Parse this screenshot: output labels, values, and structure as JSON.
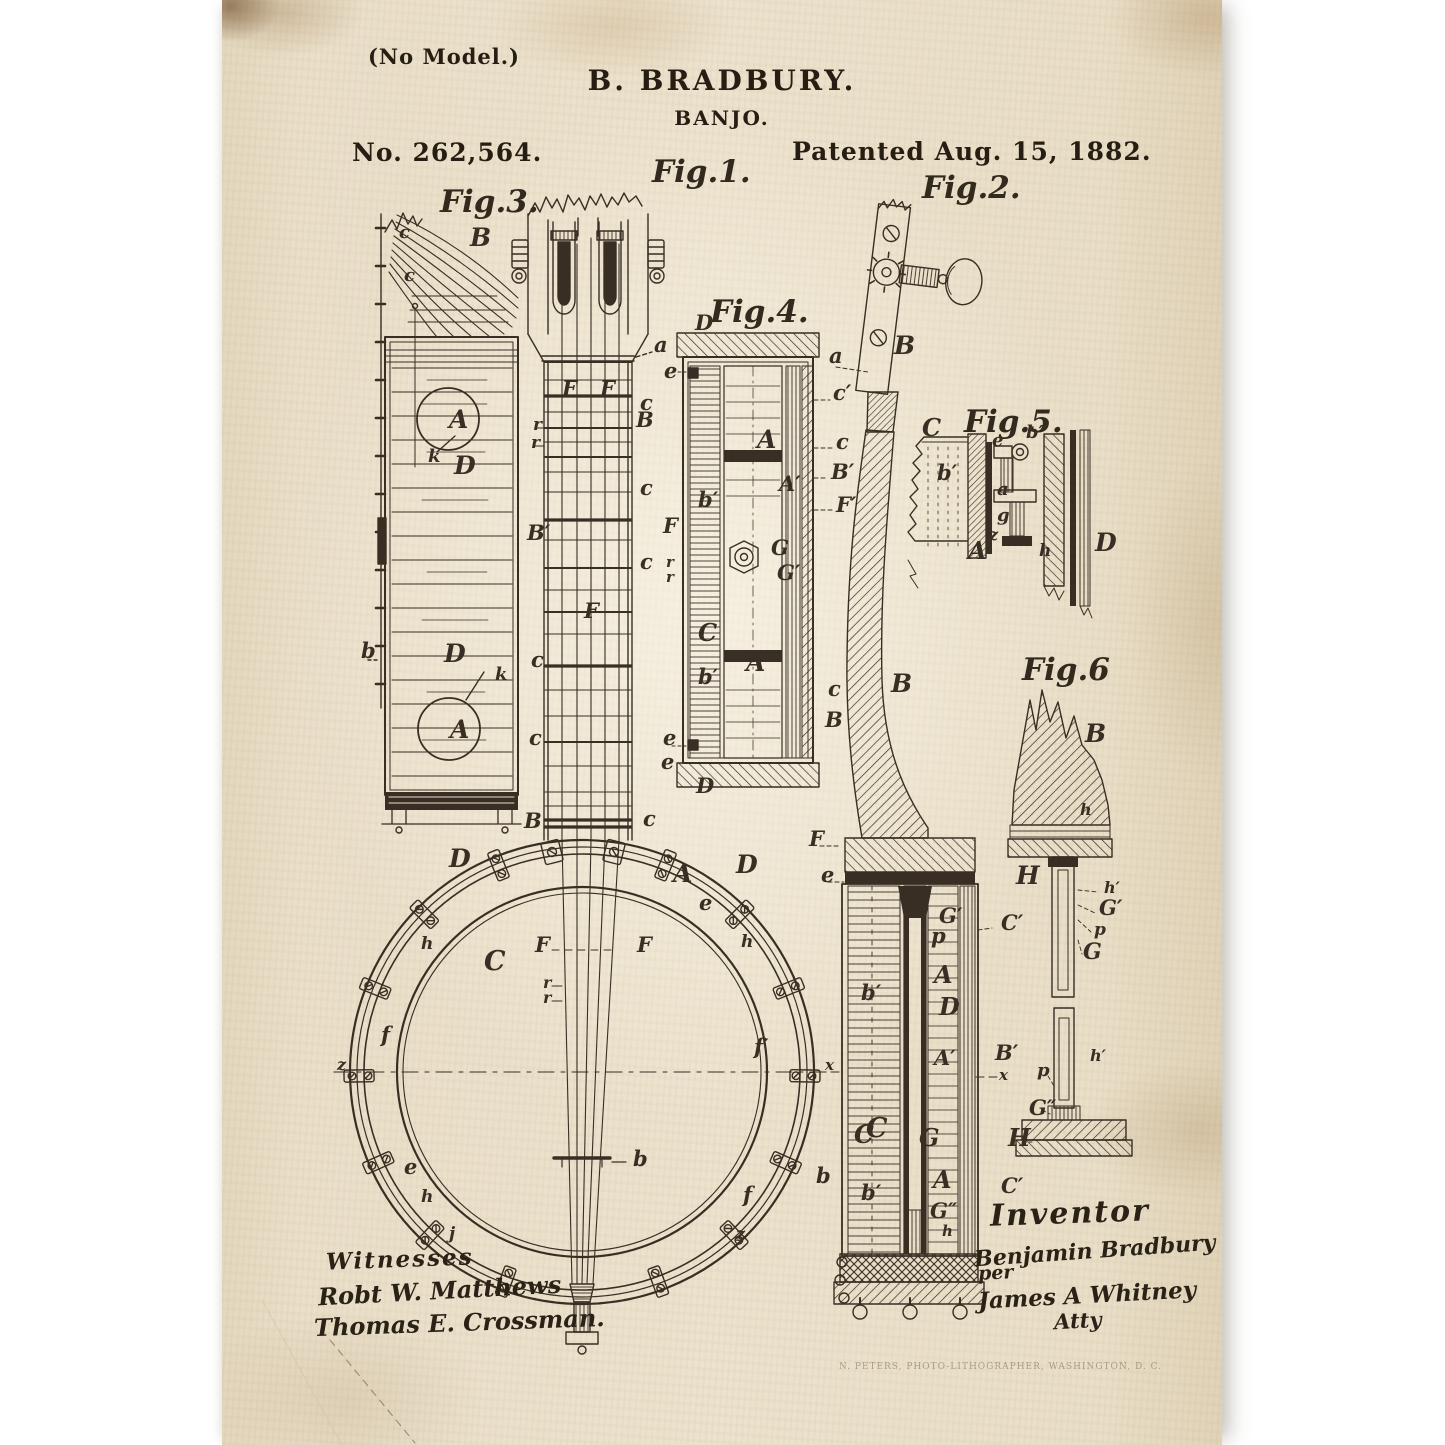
{
  "page": {
    "header": {
      "no_model": "(No Model.)",
      "inventor_line": "B. BRADBURY.",
      "title": "BANJO.",
      "patent_number": "No. 262,564.",
      "patent_date": "Patented Aug. 15, 1882."
    },
    "figures": [
      {
        "id": "fig1",
        "label": "Fig.1.",
        "label_pos": {
          "x": 430,
          "y": 182
        },
        "description": "banjo front elevation",
        "part_labels": [
          {
            "t": "a",
            "x": 432,
            "y": 352
          },
          {
            "t": "e",
            "x": 442,
            "y": 378
          },
          {
            "t": "F",
            "x": 340,
            "y": 396
          },
          {
            "t": "F",
            "x": 378,
            "y": 396
          },
          {
            "t": "c",
            "x": 418,
            "y": 410
          },
          {
            "t": "B",
            "x": 414,
            "y": 427
          },
          {
            "t": "r",
            "x": 311,
            "y": 430,
            "s": 17
          },
          {
            "t": "r",
            "x": 309,
            "y": 448,
            "s": 17
          },
          {
            "t": "c",
            "x": 418,
            "y": 495
          },
          {
            "t": "B′",
            "x": 305,
            "y": 540
          },
          {
            "t": "F",
            "x": 362,
            "y": 618
          },
          {
            "t": "c",
            "x": 418,
            "y": 569
          },
          {
            "t": "c",
            "x": 309,
            "y": 667
          },
          {
            "t": "c",
            "x": 307,
            "y": 745
          },
          {
            "t": "B",
            "x": 302,
            "y": 828
          },
          {
            "t": "c",
            "x": 421,
            "y": 826
          },
          {
            "t": "D",
            "x": 227,
            "y": 867,
            "s": 25
          },
          {
            "t": "D",
            "x": 514,
            "y": 873,
            "s": 25
          },
          {
            "t": "A",
            "x": 451,
            "y": 882,
            "s": 25
          },
          {
            "t": "e",
            "x": 477,
            "y": 910
          },
          {
            "t": "h",
            "x": 199,
            "y": 949,
            "s": 17
          },
          {
            "t": "h",
            "x": 519,
            "y": 947,
            "s": 17
          },
          {
            "t": "C",
            "x": 262,
            "y": 970,
            "s": 27
          },
          {
            "t": "F",
            "x": 313,
            "y": 952
          },
          {
            "t": "F",
            "x": 415,
            "y": 952
          },
          {
            "t": "r",
            "x": 321,
            "y": 988,
            "s": 16
          },
          {
            "t": "r",
            "x": 321,
            "y": 1003,
            "s": 16
          },
          {
            "t": "f",
            "x": 159,
            "y": 1042
          },
          {
            "t": "f′",
            "x": 532,
            "y": 1054
          },
          {
            "t": "z",
            "x": 115,
            "y": 1070,
            "s": 16
          },
          {
            "t": "C",
            "x": 644,
            "y": 1137,
            "s": 27
          },
          {
            "t": "b",
            "x": 411,
            "y": 1166
          },
          {
            "t": "e",
            "x": 182,
            "y": 1174
          },
          {
            "t": "h",
            "x": 199,
            "y": 1202,
            "s": 17
          },
          {
            "t": "j",
            "x": 227,
            "y": 1239,
            "s": 17
          },
          {
            "t": "f",
            "x": 521,
            "y": 1202
          },
          {
            "t": "z",
            "x": 514,
            "y": 1239,
            "s": 16
          }
        ]
      },
      {
        "id": "fig2",
        "label": "Fig.2.",
        "label_pos": {
          "x": 700,
          "y": 198
        },
        "description": "banjo side sectional view",
        "part_labels": [
          {
            "t": "B",
            "x": 672,
            "y": 354,
            "s": 25
          },
          {
            "t": "a",
            "x": 607,
            "y": 363
          },
          {
            "t": "B",
            "x": 669,
            "y": 692,
            "s": 25
          },
          {
            "t": "F",
            "x": 587,
            "y": 846
          },
          {
            "t": "e",
            "x": 599,
            "y": 882
          },
          {
            "t": "G′",
            "x": 717,
            "y": 923
          },
          {
            "t": "p",
            "x": 709,
            "y": 943
          },
          {
            "t": "C′",
            "x": 779,
            "y": 930
          },
          {
            "t": "A",
            "x": 712,
            "y": 983,
            "s": 24
          },
          {
            "t": "b′",
            "x": 639,
            "y": 1000
          },
          {
            "t": "D",
            "x": 717,
            "y": 1015,
            "s": 24
          },
          {
            "t": "A′",
            "x": 712,
            "y": 1065
          },
          {
            "t": "B′",
            "x": 773,
            "y": 1060
          },
          {
            "t": "x",
            "x": 777,
            "y": 1080,
            "s": 15
          },
          {
            "t": "x",
            "x": 603,
            "y": 1070,
            "s": 15
          },
          {
            "t": "C",
            "x": 632,
            "y": 1143,
            "s": 25
          },
          {
            "t": "G",
            "x": 697,
            "y": 1146,
            "s": 24
          },
          {
            "t": "b",
            "x": 594,
            "y": 1183
          },
          {
            "t": "b′",
            "x": 639,
            "y": 1200
          },
          {
            "t": "A",
            "x": 711,
            "y": 1188,
            "s": 24
          },
          {
            "t": "C′",
            "x": 779,
            "y": 1193
          },
          {
            "t": "G″",
            "x": 708,
            "y": 1218
          },
          {
            "t": "h",
            "x": 720,
            "y": 1236,
            "s": 15
          }
        ]
      },
      {
        "id": "fig3",
        "label": "Fig.3.",
        "label_pos": {
          "x": 218,
          "y": 212
        },
        "description": "rim developed view",
        "part_labels": [
          {
            "t": "c",
            "x": 177,
            "y": 238,
            "s": 18
          },
          {
            "t": "B",
            "x": 248,
            "y": 246,
            "s": 25
          },
          {
            "t": "c",
            "x": 182,
            "y": 281,
            "s": 18
          },
          {
            "t": "A",
            "x": 227,
            "y": 428,
            "s": 25
          },
          {
            "t": "k",
            "x": 206,
            "y": 462,
            "s": 18
          },
          {
            "t": "D",
            "x": 232,
            "y": 474,
            "s": 25
          },
          {
            "t": "b",
            "x": 139,
            "y": 658
          },
          {
            "t": "D",
            "x": 222,
            "y": 662,
            "s": 25
          },
          {
            "t": "k",
            "x": 273,
            "y": 680,
            "s": 18
          },
          {
            "t": "A",
            "x": 228,
            "y": 738,
            "s": 25
          }
        ]
      },
      {
        "id": "fig4",
        "label": "Fig.4.",
        "label_pos": {
          "x": 488,
          "y": 322
        },
        "description": "rim cross-section",
        "part_labels": [
          {
            "t": "D",
            "x": 473,
            "y": 330
          },
          {
            "t": "c′",
            "x": 611,
            "y": 400
          },
          {
            "t": "A",
            "x": 535,
            "y": 448,
            "s": 25
          },
          {
            "t": "c",
            "x": 614,
            "y": 449
          },
          {
            "t": "A′",
            "x": 557,
            "y": 491
          },
          {
            "t": "B′",
            "x": 609,
            "y": 479
          },
          {
            "t": "F′",
            "x": 614,
            "y": 512
          },
          {
            "t": "F",
            "x": 441,
            "y": 533
          },
          {
            "t": "G",
            "x": 549,
            "y": 555
          },
          {
            "t": "r",
            "x": 444,
            "y": 567,
            "s": 15
          },
          {
            "t": "G′",
            "x": 555,
            "y": 580
          },
          {
            "t": "r",
            "x": 444,
            "y": 582,
            "s": 15
          },
          {
            "t": "b′",
            "x": 476,
            "y": 507
          },
          {
            "t": "C",
            "x": 476,
            "y": 641,
            "s": 24
          },
          {
            "t": "b′",
            "x": 476,
            "y": 684
          },
          {
            "t": "A",
            "x": 524,
            "y": 671,
            "s": 25
          },
          {
            "t": "c",
            "x": 606,
            "y": 696
          },
          {
            "t": "B",
            "x": 603,
            "y": 727
          },
          {
            "t": "e",
            "x": 441,
            "y": 745
          },
          {
            "t": "e",
            "x": 439,
            "y": 769
          },
          {
            "t": "D",
            "x": 474,
            "y": 793
          }
        ]
      },
      {
        "id": "fig5",
        "label": "Fig.5.",
        "label_pos": {
          "x": 742,
          "y": 432
        },
        "description": "bracket detail section",
        "part_labels": [
          {
            "t": "C",
            "x": 700,
            "y": 436,
            "s": 24
          },
          {
            "t": "e",
            "x": 770,
            "y": 446,
            "s": 18
          },
          {
            "t": "b″",
            "x": 804,
            "y": 438,
            "s": 18
          },
          {
            "t": "b′",
            "x": 715,
            "y": 480
          },
          {
            "t": "a",
            "x": 775,
            "y": 495,
            "s": 18
          },
          {
            "t": "g",
            "x": 775,
            "y": 521,
            "s": 18
          },
          {
            "t": "z",
            "x": 767,
            "y": 540,
            "s": 16
          },
          {
            "t": "A",
            "x": 746,
            "y": 559,
            "s": 24
          },
          {
            "t": "h",
            "x": 817,
            "y": 556,
            "s": 17
          },
          {
            "t": "D",
            "x": 873,
            "y": 551,
            "s": 25
          }
        ]
      },
      {
        "id": "fig6",
        "label": "Fig.6",
        "label_pos": {
          "x": 800,
          "y": 680
        },
        "description": "neck heel and rod detail",
        "part_labels": [
          {
            "t": "B",
            "x": 863,
            "y": 742,
            "s": 25
          },
          {
            "t": "h",
            "x": 858,
            "y": 815,
            "s": 16
          },
          {
            "t": "H",
            "x": 794,
            "y": 884,
            "s": 25
          },
          {
            "t": "h′",
            "x": 882,
            "y": 893,
            "s": 16
          },
          {
            "t": "G′",
            "x": 877,
            "y": 915
          },
          {
            "t": "p",
            "x": 872,
            "y": 935,
            "s": 17
          },
          {
            "t": "G",
            "x": 861,
            "y": 959,
            "s": 22
          },
          {
            "t": "h′",
            "x": 868,
            "y": 1061,
            "s": 16
          },
          {
            "t": "p",
            "x": 815,
            "y": 1076,
            "s": 18
          },
          {
            "t": "G″",
            "x": 807,
            "y": 1115
          },
          {
            "t": "H",
            "x": 786,
            "y": 1146,
            "s": 24
          }
        ]
      }
    ],
    "witnesses": {
      "heading": "Witnesses",
      "signatures": [
        "Robt W. Matthews",
        "Thomas E. Crossman."
      ]
    },
    "inventor_block": {
      "heading": "Inventor",
      "signature": "Benjamin Bradbury",
      "per": "per",
      "attorney_signature": "James A Whitney",
      "attorney_title": "Atty"
    },
    "printer_line": "N. PETERS, PHOTO-LITHOGRAPHER, WASHINGTON, D. C."
  },
  "colors": {
    "ink": "#2a2117",
    "paper": "#eadfc9"
  }
}
